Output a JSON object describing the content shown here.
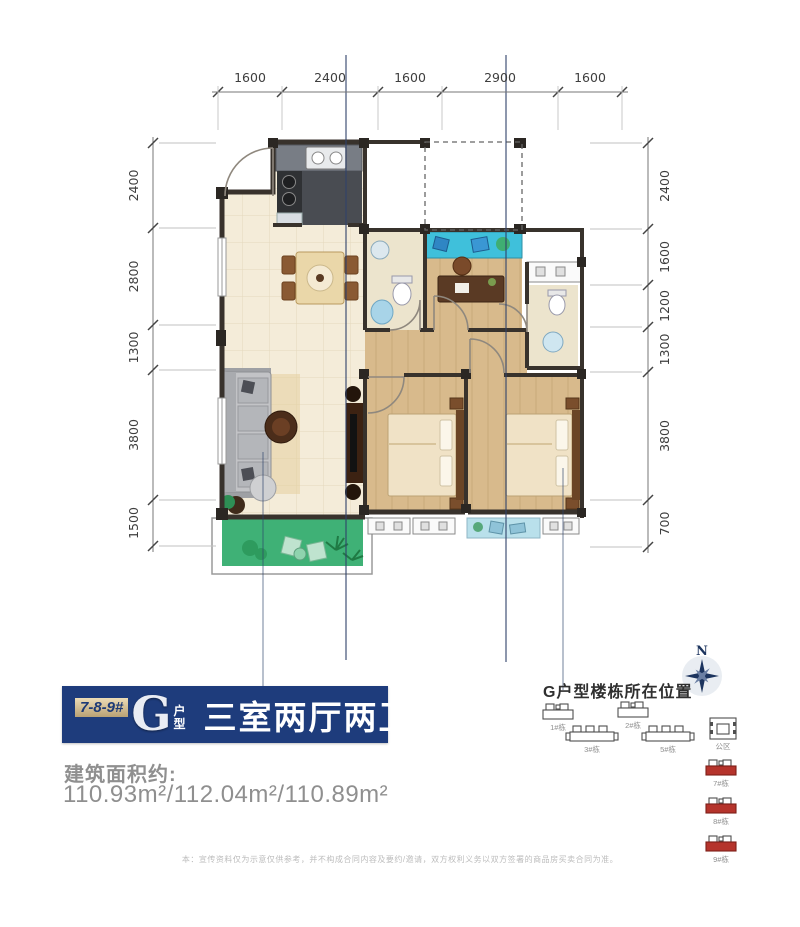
{
  "page": {
    "background": "#ffffff"
  },
  "floor_plan": {
    "dimensions": {
      "top": [
        "1600",
        "2400",
        "1600",
        "2900",
        "1600"
      ],
      "left": [
        "2400",
        "2800",
        "1300",
        "3800",
        "1500"
      ],
      "right": [
        "2400",
        "1600",
        "1200",
        "1300",
        "3800",
        "700"
      ]
    },
    "colors": {
      "wall": "#38322c",
      "tile_floor": "#f4ecd9",
      "wood_floor": "#d8ba8c",
      "balcony_green": "#3fb176",
      "bay_window_teal": "#3fc0db",
      "bay_window_light_blue": "#b9e0eb"
    }
  },
  "unit_banner": {
    "building_numbers": "7-8-9#",
    "unit_letter": "G",
    "unit_word_top": "户",
    "unit_word_bottom": "型",
    "title": "三室两厅两卫",
    "background": "#1e3c7c"
  },
  "area": {
    "label": "建筑面积约:",
    "values": "110.93m²/112.04m²/110.89m²"
  },
  "sitemap": {
    "title": "G户型楼栋所在位置",
    "compass_label": "N",
    "highlight_color": "#b5342c",
    "buildings": [
      {
        "label": "1#栋",
        "type": "small",
        "highlighted": false
      },
      {
        "label": "2#栋",
        "type": "small",
        "highlighted": false
      },
      {
        "label": "3#栋",
        "type": "long",
        "highlighted": false
      },
      {
        "label": "5#栋",
        "type": "long",
        "highlighted": false
      },
      {
        "label": "公区",
        "type": "block",
        "highlighted": false
      },
      {
        "label": "7#栋",
        "type": "small",
        "highlighted": true
      },
      {
        "label": "8#栋",
        "type": "small",
        "highlighted": true
      },
      {
        "label": "9#栋",
        "type": "small",
        "highlighted": true
      }
    ]
  },
  "disclaimer": "本：宣传资料仅为示意仅供参考，并不构成合同内容及要约/邀请，双方权利义务以双方签署的商品房买卖合同为准。"
}
